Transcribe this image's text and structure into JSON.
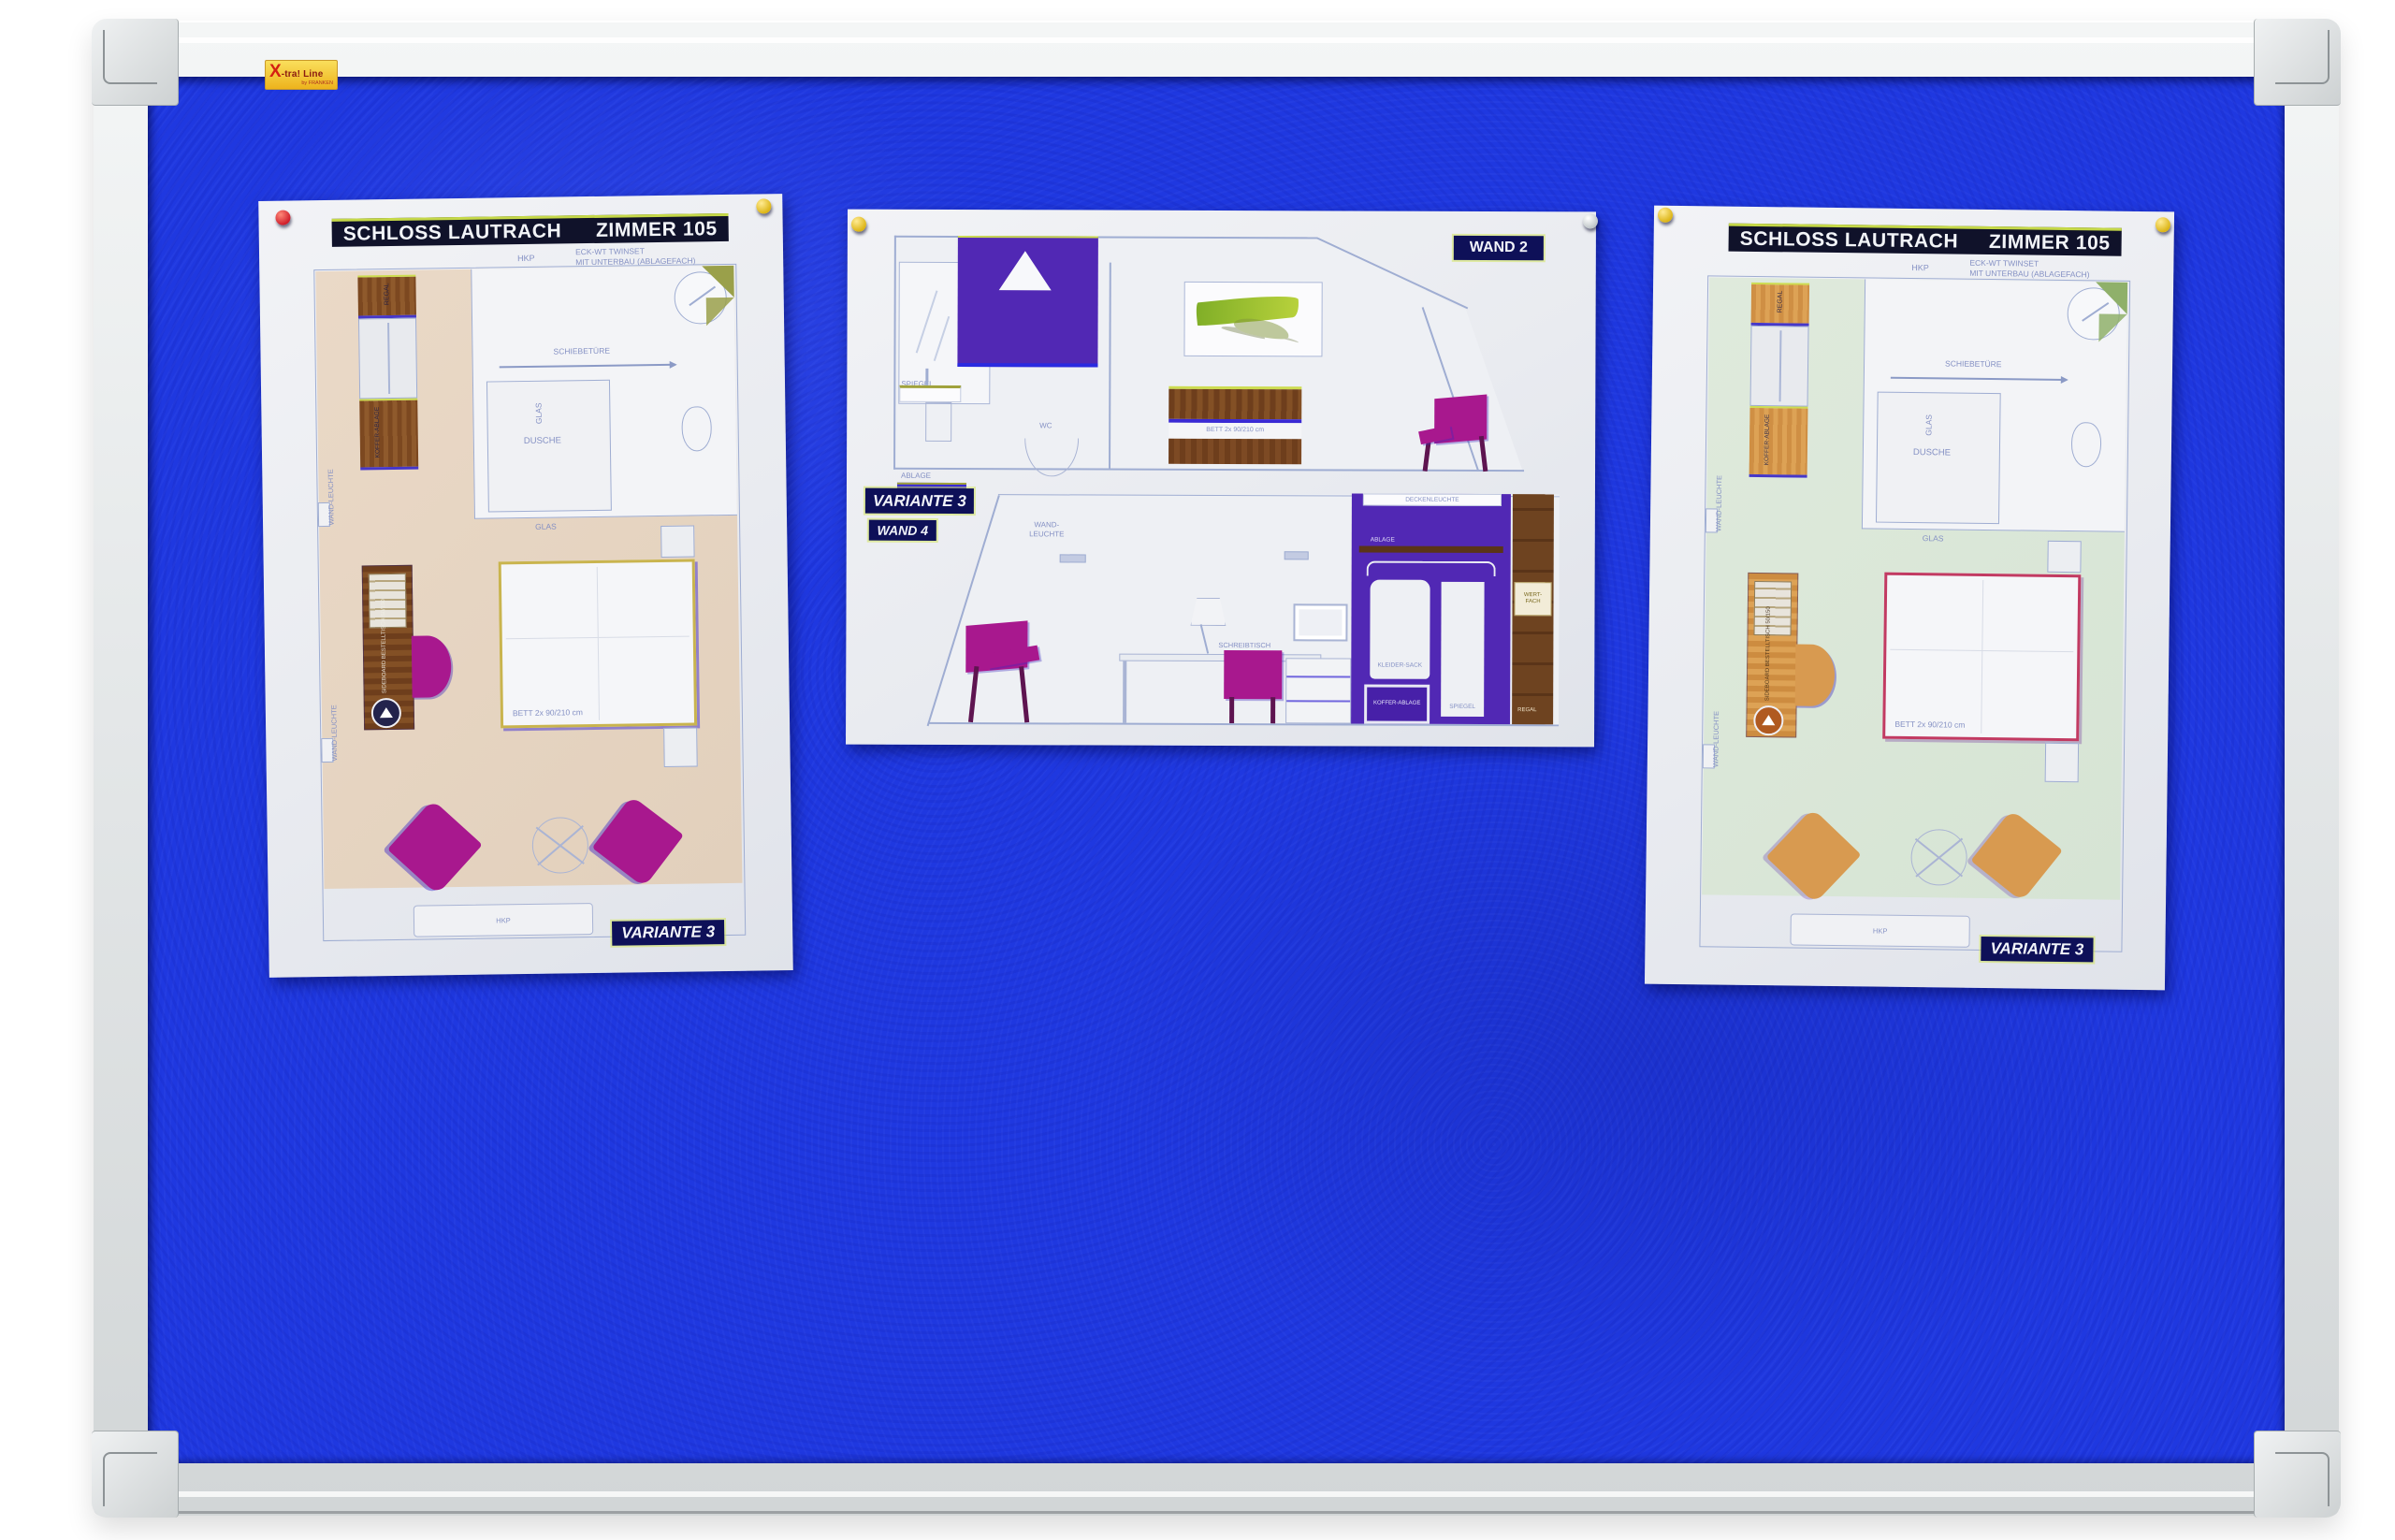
{
  "brand": {
    "x": "X",
    "rest": "-tra! Line",
    "by": "by FRANKEN"
  },
  "colors": {
    "felt_blue": "#1f38e0",
    "frame_gray": "#e3e6e7",
    "paper": "#eceef2",
    "floor_beige": "#e7d7c6",
    "floor_mint": "#dde9da",
    "wood_dark": "#7d4a22",
    "wood_light": "#d4944a",
    "magenta": "#a8188e",
    "orange": "#d89a50",
    "purple_wall": "#5128b4",
    "chartreuse": "#cfe24a",
    "header_bg": "#10122a",
    "tag_bg": "#0e1058",
    "pin_red": "#cf1d2a",
    "pin_yellow": "#dcb414",
    "pin_gray": "#b9c0c3"
  },
  "doc_left": {
    "title": "SCHLOSS  LAUTRACH",
    "room": "ZIMMER 105",
    "hkp_top": "HKP",
    "eck_line1": "ECK-WT TWINSET",
    "eck_line2": "MIT UNTERBAU (ABLAGEFACH)",
    "schiebetuere": "SCHIEBETÜRE",
    "dusche": "DUSCHE",
    "glas_v": "GLAS",
    "glas_h": "GLAS",
    "regal": "REGAL",
    "koffer_ablage": "KOFFER-ABLAGE",
    "wandleuchte": "WAND-LEUCHTE",
    "desk_note": "SIDEBOARD BESTELLTISCH 50/150",
    "bett": "BETT 2x 90/210 cm",
    "hkp_radiator": "HKP",
    "variante": "VARIANTE 3"
  },
  "doc_middle": {
    "wand2": "WAND 2",
    "variante": "VARIANTE 3",
    "wand4": "WAND 4",
    "spiegel_bath": "SPIEGEL",
    "wc": "WC",
    "ablage_bath": "ABLAGE",
    "bett": "BETT 2x 90/210 cm",
    "wandleuchte": "WAND-LEUCHTE",
    "deckenleuchte": "DECKENLEUCHTE",
    "ablage_shelf": "ABLAGE",
    "kleidersack": "KLEIDER-SACK",
    "koffer_ablage": "KOFFER-ABLAGE",
    "spiegel_wardrobe": "SPIEGEL",
    "wertfach": "WERT-FACH",
    "regal": "REGAL",
    "schreibtisch": "SCHREIBTISCH"
  },
  "doc_right": {
    "title": "SCHLOSS  LAUTRACH",
    "room": "ZIMMER 105",
    "hkp_top": "HKP",
    "eck_line1": "ECK-WT TWINSET",
    "eck_line2": "MIT UNTERBAU (ABLAGEFACH)",
    "schiebetuere": "SCHIEBETÜRE",
    "dusche": "DUSCHE",
    "glas_v": "GLAS",
    "glas_h": "GLAS",
    "regal": "REGAL",
    "koffer_ablage": "KOFFER-ABLAGE",
    "wandleuchte": "WAND-LEUCHTE",
    "desk_note": "SIDEBOARD BESTELLTISCH 50/150",
    "bett": "BETT 2x 90/210 cm",
    "hkp_radiator": "HKP",
    "variante": "VARIANTE 3"
  }
}
